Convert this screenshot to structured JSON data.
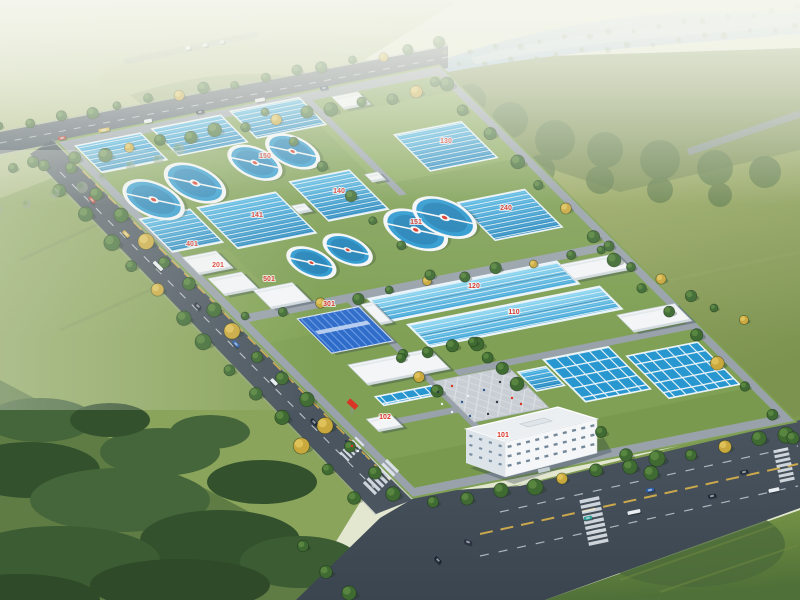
{
  "scene": {
    "description": "Aerial architectural rendering of a large water treatment plant campus with blue sedimentation basins, circular clarifier tanks, white plant buildings, a blue-roofed workshop, an entrance plaza and office building, surrounded by tree-lined arterial roads, green fields, forest and a hazy river on the horizon"
  },
  "colors": {
    "skyBase": "#e3e7d0",
    "hillLight": "#ccd3a8",
    "hillMid": "#a9b87f",
    "hillDark": "#8da06a",
    "fieldEastLight": "#a8b46e",
    "fieldEastDark": "#7c9350",
    "fieldBRLight": "#7d9a48",
    "fieldBRDark": "#4f7038",
    "forestBand": "#7f9257",
    "forestBlob": "#5e7a49",
    "meadow": "#8aa45c",
    "forestDark": "#33512c",
    "forestMid": "#45663a",
    "river": "#b7cede",
    "riverDeep": "#9fbcd4",
    "roadAsphalt": "#4a555f",
    "roadNorth": "#57626d",
    "roadDark": "#3e4852",
    "curb": "#a8b0b8",
    "markWhite": "#e9eef2",
    "markYellow": "#d9b24a",
    "grass": "#7fa055",
    "innerRoad": "#99a2ab",
    "poolBlue": "#2897cf",
    "poolDeep": "#1d7cb4",
    "laneWhite": "#eaf4fa",
    "channelLight": "#8fd8f2",
    "wallWhite": "#f3f5f7",
    "roofBlue": "#2f6cc9",
    "roofRidge": "#6fa0e8",
    "plaza": "#c9ced4",
    "windowBlue": "#5d7488",
    "treeGreen": "#3f6b33",
    "treeLight": "#5d8a42",
    "treeAutumn": "#c9a83d",
    "red": "#d93425"
  },
  "plant_labels": [
    {
      "text": "101",
      "x": 503,
      "y": 437
    },
    {
      "text": "102",
      "x": 385,
      "y": 419
    },
    {
      "text": "301",
      "x": 329,
      "y": 306
    },
    {
      "text": "401",
      "x": 192,
      "y": 246
    },
    {
      "text": "201",
      "x": 218,
      "y": 267
    },
    {
      "text": "501",
      "x": 269,
      "y": 281
    },
    {
      "text": "141",
      "x": 257,
      "y": 217
    },
    {
      "text": "140",
      "x": 339,
      "y": 193
    },
    {
      "text": "240",
      "x": 506,
      "y": 210
    },
    {
      "text": "130",
      "x": 446,
      "y": 143
    },
    {
      "text": "120",
      "x": 474,
      "y": 288
    },
    {
      "text": "110",
      "x": 514,
      "y": 314
    },
    {
      "text": "150",
      "x": 265,
      "y": 158
    },
    {
      "text": "151",
      "x": 416,
      "y": 224
    }
  ],
  "clarifiers": [
    [
      34,
      82,
      24
    ],
    [
      86,
      73,
      24
    ],
    [
      158,
      64,
      21
    ],
    [
      202,
      60,
      21
    ],
    [
      119,
      183,
      19
    ],
    [
      163,
      177,
      19
    ],
    [
      242,
      170,
      25
    ],
    [
      279,
      163,
      25
    ]
  ],
  "basins": [
    {
      "u": 12,
      "v": 8,
      "w": 70,
      "h": 34,
      "kind": "lanes"
    },
    {
      "u": 96,
      "v": 6,
      "w": 74,
      "h": 34,
      "kind": "lanes"
    },
    {
      "u": 182,
      "v": 4,
      "w": 74,
      "h": 34,
      "kind": "lanes"
    },
    {
      "u": 4,
      "v": 100,
      "w": 54,
      "h": 42,
      "kind": "lanes"
    },
    {
      "u": 66,
      "v": 100,
      "w": 84,
      "h": 52,
      "kind": "lanes"
    },
    {
      "u": 172,
      "v": 92,
      "w": 64,
      "h": 50,
      "kind": "lanes"
    },
    {
      "u": 308,
      "v": 64,
      "w": 72,
      "h": 46,
      "kind": "lanes"
    },
    {
      "u": 304,
      "v": 150,
      "w": 72,
      "h": 48,
      "kind": "lanes"
    },
    {
      "u": 206,
      "v": 344,
      "w": 30,
      "h": 24,
      "kind": "lanes"
    },
    {
      "u": 138,
      "v": 234,
      "w": 202,
      "h": 28,
      "kind": "channel"
    },
    {
      "u": 150,
      "v": 270,
      "w": 206,
      "h": 28,
      "kind": "channel"
    },
    {
      "u": 240,
      "v": 336,
      "w": 70,
      "h": 54,
      "kind": "cells"
    },
    {
      "u": 318,
      "v": 350,
      "w": 76,
      "h": 54,
      "kind": "cells"
    },
    {
      "u": 56,
      "v": 340,
      "w": 60,
      "h": 11,
      "kind": "cells"
    }
  ],
  "buildings": [
    {
      "u": 8,
      "v": 150,
      "w": 36,
      "h": 22
    },
    {
      "u": 12,
      "v": 178,
      "w": 36,
      "h": 22
    },
    {
      "u": 42,
      "v": 200,
      "w": 42,
      "h": 24
    },
    {
      "u": 56,
      "v": 240,
      "w": 66,
      "h": 44,
      "roof": "blue"
    },
    {
      "u": 28,
      "v": 362,
      "w": 26,
      "h": 16
    },
    {
      "u": 60,
      "v": 300,
      "w": 88,
      "h": 26
    },
    {
      "u": 340,
      "v": 238,
      "w": 60,
      "h": 20
    },
    {
      "u": 346,
      "v": 304,
      "w": 62,
      "h": 22
    },
    {
      "u": 286,
      "v": 10,
      "w": 28,
      "h": 16
    },
    {
      "u": 152,
      "v": 118,
      "w": 14,
      "h": 10
    },
    {
      "u": 246,
      "v": 100,
      "w": 14,
      "h": 10
    },
    {
      "u": 126,
      "v": 238,
      "w": 12,
      "h": 26
    }
  ],
  "vehicles": [
    {
      "x": 62,
      "y": 138,
      "a": -11,
      "c": "#b03a2e"
    },
    {
      "x": 104,
      "y": 130,
      "a": -11,
      "c": "#d8b23c",
      "l": 11
    },
    {
      "x": 148,
      "y": 121,
      "a": -11,
      "c": "#e8ecef"
    },
    {
      "x": 200,
      "y": 112,
      "a": -11,
      "c": "#2a3140"
    },
    {
      "x": 260,
      "y": 100,
      "a": -11,
      "c": "#e8ecef",
      "l": 10
    },
    {
      "x": 324,
      "y": 88,
      "a": -11,
      "c": "#30425c"
    },
    {
      "x": 188,
      "y": 48,
      "a": -12,
      "c": "#eef0f2",
      "l": 5
    },
    {
      "x": 205,
      "y": 45,
      "a": -12,
      "c": "#e6e9ec",
      "l": 5
    },
    {
      "x": 222,
      "y": 42,
      "a": -12,
      "c": "#dfe3e6",
      "l": 4
    },
    {
      "x": 92,
      "y": 200,
      "a": 45,
      "c": "#b03a2e"
    },
    {
      "x": 126,
      "y": 234,
      "a": 45,
      "c": "#d8b23c"
    },
    {
      "x": 158,
      "y": 266,
      "a": 45,
      "c": "#e8ecef",
      "l": 12
    },
    {
      "x": 198,
      "y": 306,
      "a": 45,
      "c": "#2a3140"
    },
    {
      "x": 236,
      "y": 344,
      "a": 45,
      "c": "#2b5fb0"
    },
    {
      "x": 274,
      "y": 382,
      "a": 45,
      "c": "#e8ecef"
    },
    {
      "x": 314,
      "y": 422,
      "a": 45,
      "c": "#1f2a38"
    },
    {
      "x": 588,
      "y": 518,
      "a": -12,
      "c": "#2aa198"
    },
    {
      "x": 634,
      "y": 512,
      "a": -12,
      "c": "#e8ecef",
      "l": 13
    },
    {
      "x": 650,
      "y": 490,
      "a": -12,
      "c": "#2b5fb0"
    },
    {
      "x": 712,
      "y": 496,
      "a": -12,
      "c": "#1f2a38"
    },
    {
      "x": 744,
      "y": 472,
      "a": -12,
      "c": "#1f2a38"
    },
    {
      "x": 774,
      "y": 490,
      "a": -12,
      "c": "#e8ecef",
      "l": 11
    },
    {
      "x": 468,
      "y": 542,
      "a": 20,
      "c": "#2a3140"
    },
    {
      "x": 438,
      "y": 560,
      "a": 45,
      "c": "#16202e"
    }
  ],
  "people": [
    [
      438,
      392
    ],
    [
      452,
      386
    ],
    [
      468,
      396
    ],
    [
      484,
      390
    ],
    [
      497,
      402
    ],
    [
      512,
      398
    ],
    [
      452,
      412
    ],
    [
      470,
      416
    ],
    [
      500,
      382
    ],
    [
      521,
      404
    ],
    [
      442,
      404
    ],
    [
      462,
      402
    ],
    [
      488,
      414
    ],
    [
      352,
      446
    ],
    [
      358,
      451
    ],
    [
      364,
      456
    ],
    [
      346,
      441
    ]
  ],
  "crosswalks": [
    {
      "cx": 381,
      "cy": 477,
      "a": 45,
      "n": 7,
      "len": 17,
      "th": 3.2,
      "step": 5.2
    },
    {
      "cx": 352,
      "cy": 449,
      "a": 45,
      "n": 6,
      "len": 12,
      "th": 2.4,
      "step": 4.2
    },
    {
      "cx": 594,
      "cy": 521,
      "a": -12,
      "n": 9,
      "len": 20,
      "th": 3.4,
      "step": 5.4
    },
    {
      "cx": 784,
      "cy": 465,
      "a": -12,
      "n": 7,
      "len": 15,
      "th": 3,
      "step": 5
    }
  ],
  "tree_rows": [
    {
      "from": [
        2,
        128
      ],
      "to": [
        440,
        44
      ],
      "n": 16,
      "r": 5,
      "acc": 7
    },
    {
      "from": [
        16,
        170
      ],
      "to": [
        448,
        86
      ],
      "n": 16,
      "r": 6,
      "acc": 5
    },
    {
      "from": [
        36,
        164
      ],
      "to": [
        352,
        496
      ],
      "n": 14,
      "r": 7,
      "acc": 6
    },
    {
      "from": [
        74,
        170
      ],
      "to": [
        396,
        494
      ],
      "n": 15,
      "r": 7,
      "acc": 4
    },
    {
      "from": [
        436,
        504
      ],
      "to": [
        788,
        434
      ],
      "n": 12,
      "r": 7,
      "acc": 5
    },
    {
      "from": [
        438,
        84
      ],
      "to": [
        796,
        438
      ],
      "n": 15,
      "r": 6,
      "acc": 6
    },
    {
      "from": [
        248,
        318
      ],
      "to": [
        606,
        248
      ],
      "n": 11,
      "r": 5,
      "acc": 3
    },
    {
      "from": [
        268,
        114
      ],
      "to": [
        428,
        274
      ],
      "n": 7,
      "r": 5
    },
    {
      "from": [
        406,
        356
      ],
      "to": [
        474,
        342
      ],
      "n": 4,
      "r": 6
    },
    {
      "from": [
        476,
        344
      ],
      "to": [
        514,
        382
      ],
      "n": 4,
      "r": 6
    },
    {
      "from": [
        404,
        360
      ],
      "to": [
        436,
        392
      ],
      "n": 3,
      "r": 6,
      "acc": 2
    },
    {
      "from": [
        448,
        54
      ],
      "to": [
        798,
        8
      ],
      "n": 16,
      "r": 3,
      "hazy": true
    },
    {
      "from": [
        462,
        66
      ],
      "to": [
        798,
        26
      ],
      "n": 15,
      "r": 3,
      "hazy": true
    },
    {
      "from": [
        2,
        212
      ],
      "to": [
        182,
        150
      ],
      "n": 8,
      "r": 5,
      "hazy": true
    },
    {
      "from": [
        604,
        252
      ],
      "to": [
        744,
        322
      ],
      "n": 6,
      "r": 5,
      "acc": 3
    },
    {
      "from": [
        604,
        434
      ],
      "to": [
        650,
        474
      ],
      "n": 3,
      "r": 7
    },
    {
      "from": [
        306,
        548
      ],
      "to": [
        348,
        594
      ],
      "n": 3,
      "r": 7
    }
  ]
}
